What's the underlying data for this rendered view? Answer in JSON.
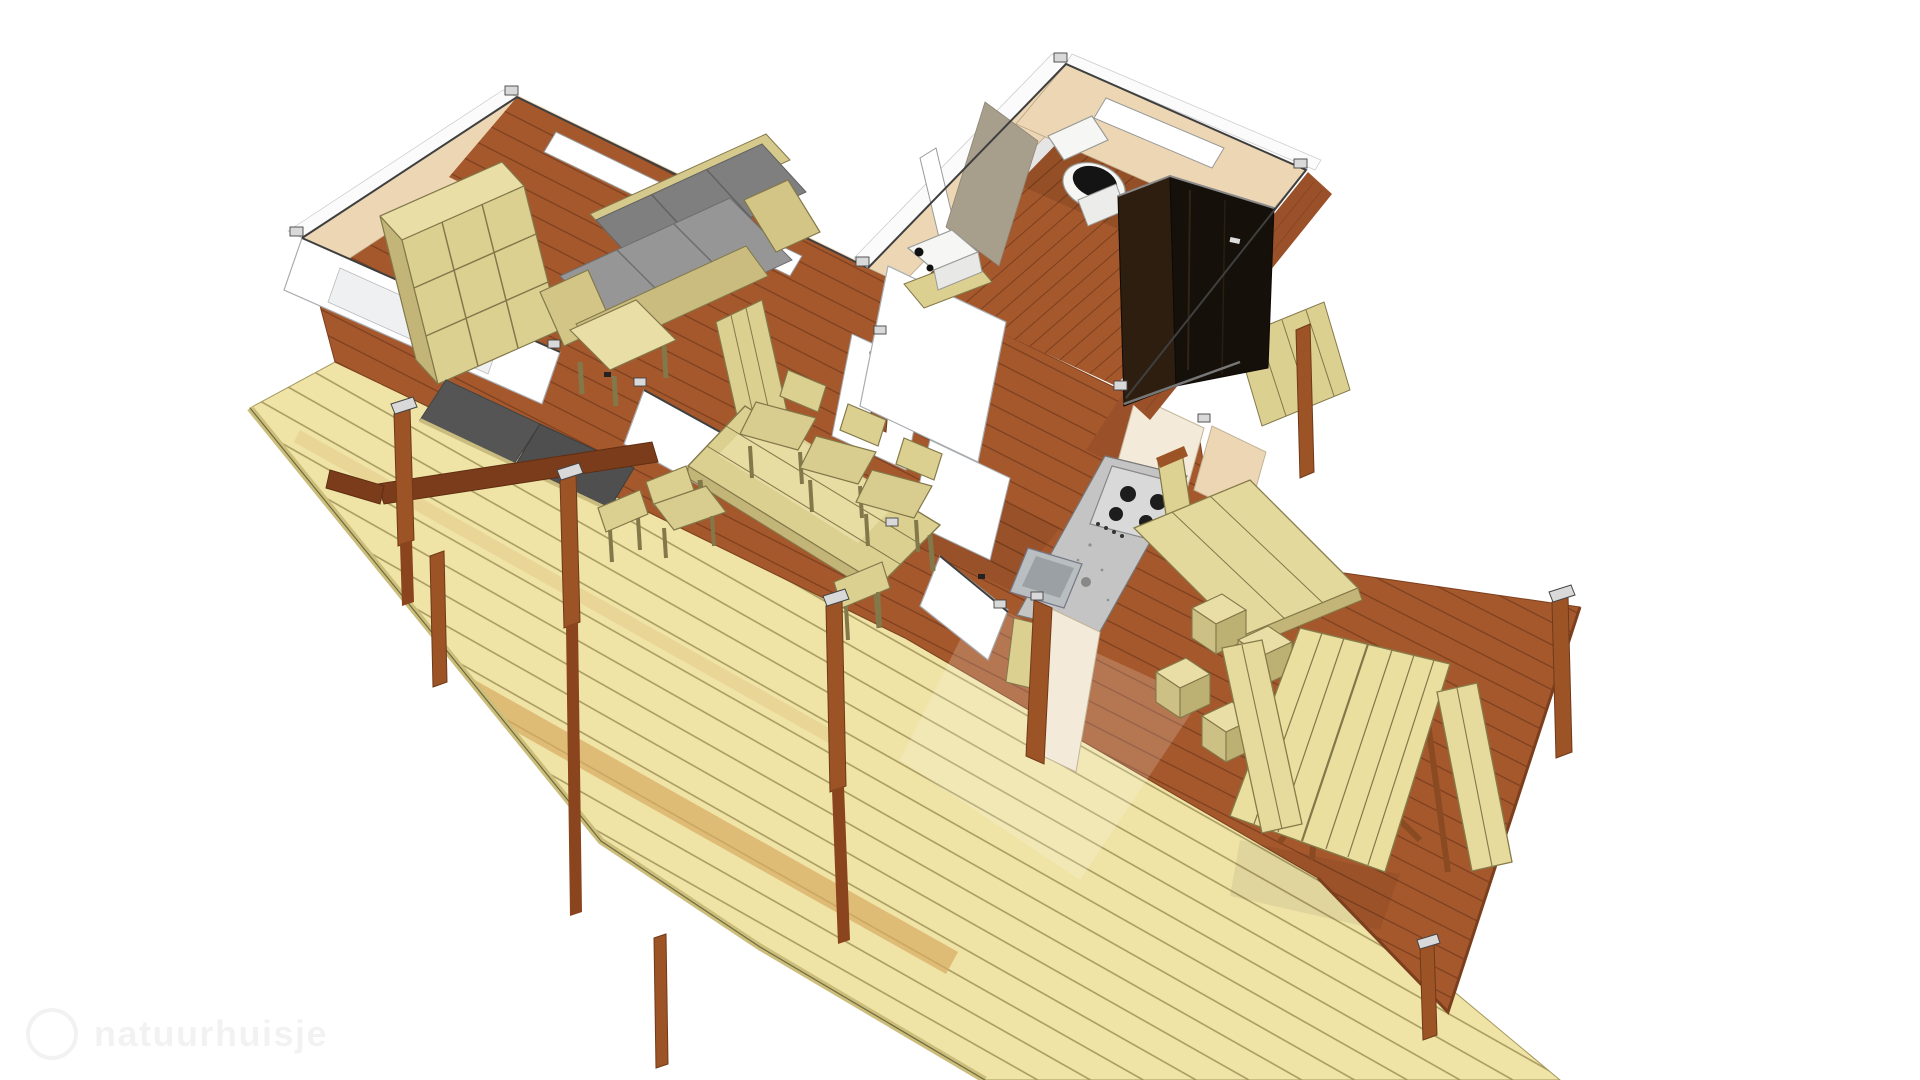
{
  "watermark": {
    "logo": "circle-logo",
    "text": "natuurhuisje"
  },
  "palette": {
    "bg": "#ffffff",
    "outline": "#3f3f3f",
    "floor": "#a5582c",
    "floorLine": "#7c3f1e",
    "floorDark": "#9a512a",
    "deckYellow": "#efe3a6",
    "deckYellowLine": "#a4975c",
    "deckYellowEdge": "#cdbd7a",
    "deckStripe": "#d8ab62",
    "wallWhite": "#ffffff",
    "wallShade": "#eef0f2",
    "wallTan": "#ecd6b4",
    "wallGray": "#a79e8b",
    "creamPanel": "#f3ead9",
    "woodLight": "#dcd091",
    "woodLightHi": "#e9dfa6",
    "woodLightLo": "#c2b577",
    "woodOutline": "#83784a",
    "sofaBack": "#7f7f7f",
    "sofaSeat": "#969696",
    "cushionDark": "#555555",
    "post": "#9c5426",
    "postDark": "#6f3a18",
    "postCap": "#d9d9d9",
    "ramp": "#7a3c1a",
    "showerL": "#2e1e10",
    "showerR": "#16100a",
    "granite": "#c4c4c4",
    "graniteDot": "#8f8f8f",
    "steel": "#d9d9d9",
    "burner": "#1d1d1d",
    "sinkSteel": "#b9bec1",
    "sinkInner": "#9aa0a3",
    "fixtureWhite": "#f6f6f4",
    "toiletSeat": "#141414"
  }
}
